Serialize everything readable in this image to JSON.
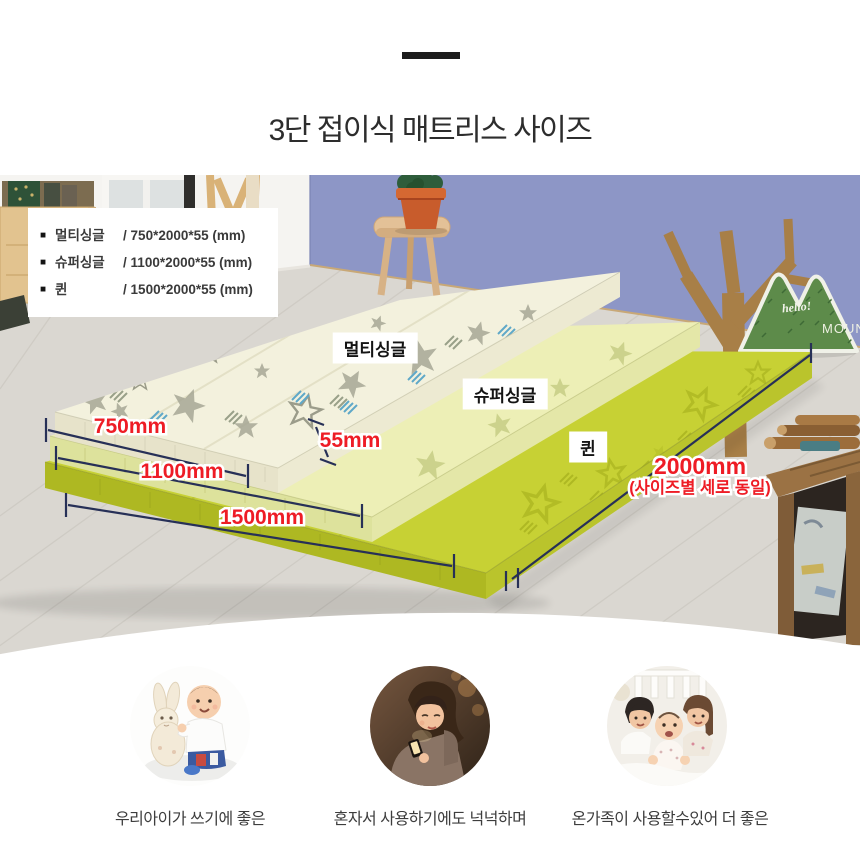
{
  "header": {
    "title": "3단 접이식 매트리스 사이즈"
  },
  "info_box": {
    "items": [
      {
        "bullet": "■",
        "name": "멀티싱글",
        "spec": "/  750*2000*55  (mm)"
      },
      {
        "bullet": "■",
        "name": "슈퍼싱글",
        "spec": "/  1100*2000*55 (mm)"
      },
      {
        "bullet": "■",
        "name": "퀸",
        "spec": "/  1500*2000*55  (mm)"
      }
    ]
  },
  "mattress_labels": {
    "multi": "멀티싱글",
    "super": "슈퍼싱글",
    "queen": "퀸"
  },
  "dimensions": {
    "multi_width": "750mm",
    "thickness": "55mm",
    "super_width": "1100mm",
    "queen_width": "1500mm",
    "length": "2000mm",
    "length_note": "(사이즈별 세로 동일)"
  },
  "cushion": {
    "line1": "hello!",
    "line2": "MOUNTAIN"
  },
  "features": [
    {
      "id": "baby-with-rabbit",
      "caption": "우리아이가 쓰기에 좋은"
    },
    {
      "id": "woman-on-mattress",
      "caption": "혼자서 사용하기에도 넉넉하며"
    },
    {
      "id": "family-on-mattress",
      "caption": "온가족이 사용할수있어 더 좋은"
    }
  ],
  "colors": {
    "wall": "#8d96c6",
    "floor": "#dad7d1",
    "mattress_multi_top": "#f3f1dd",
    "mattress_super_top": "#edefb6",
    "mattress_queen_top": "#c7d134",
    "dimension_text": "#ee1c25",
    "dimension_line": "#273057",
    "title_text": "#2d2d2d"
  }
}
